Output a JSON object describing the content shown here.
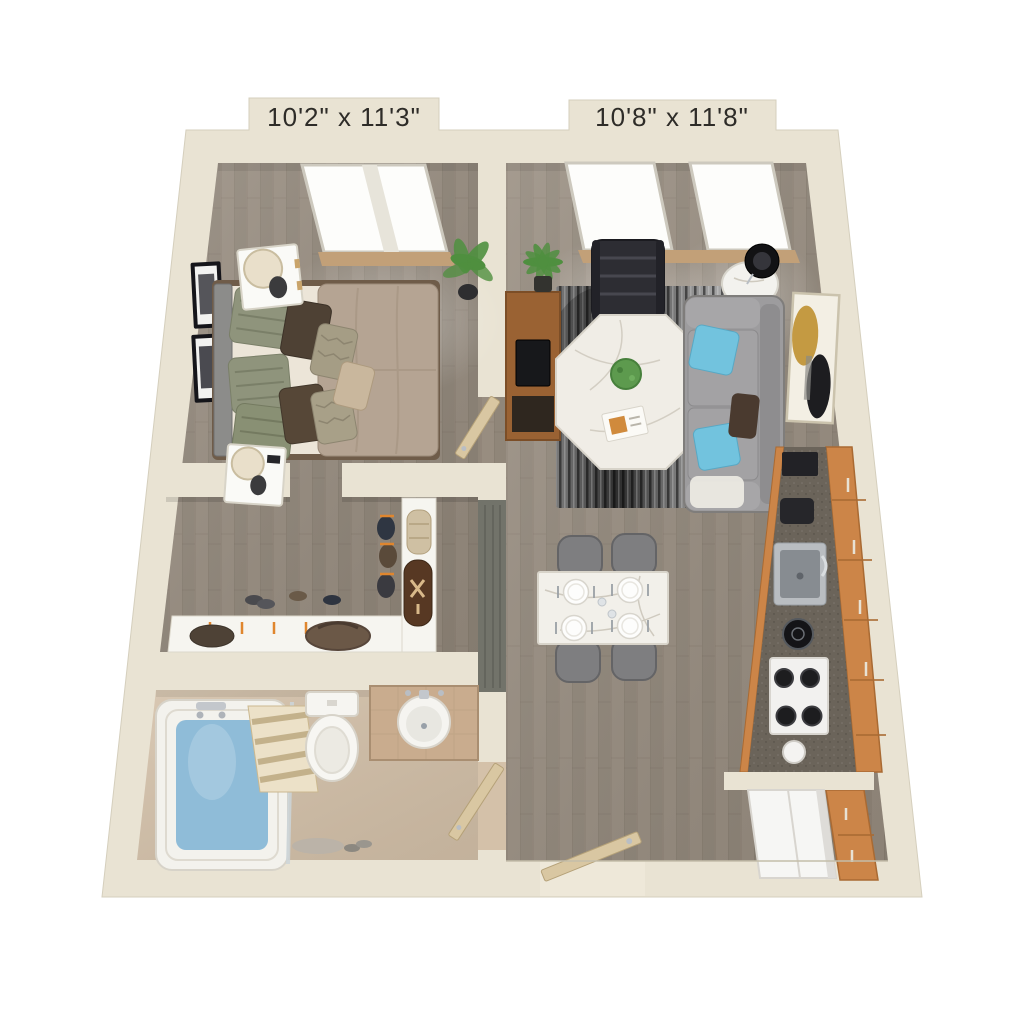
{
  "floorplan": {
    "bedroom": {
      "dimension_label": "10'2\" x 11'3\""
    },
    "living_room": {
      "dimension_label": "10'8\" x 11'8\""
    },
    "colors": {
      "background": "#ffffff",
      "wall": "#e9e3d3",
      "wall_shadow": "#cdc6b2",
      "wood_floor": "#988d80",
      "bathroom_floor": "#d4c1a9",
      "rug_dark": "#2d2d2d",
      "rug_light": "#c8c8c8",
      "sofa": "#9d9c9e",
      "accent_pillow_blue": "#72c3de",
      "bed_comforter": "#b5a493",
      "cabinet_wood": "#cc8548",
      "counter": "#6b645a",
      "tub_water": "#8fbcd8",
      "door_wood": "#d9c7a2",
      "plant_green": "#4f8f3f",
      "art_gold": "#c49a42",
      "label_text": "#2e2c28"
    }
  }
}
